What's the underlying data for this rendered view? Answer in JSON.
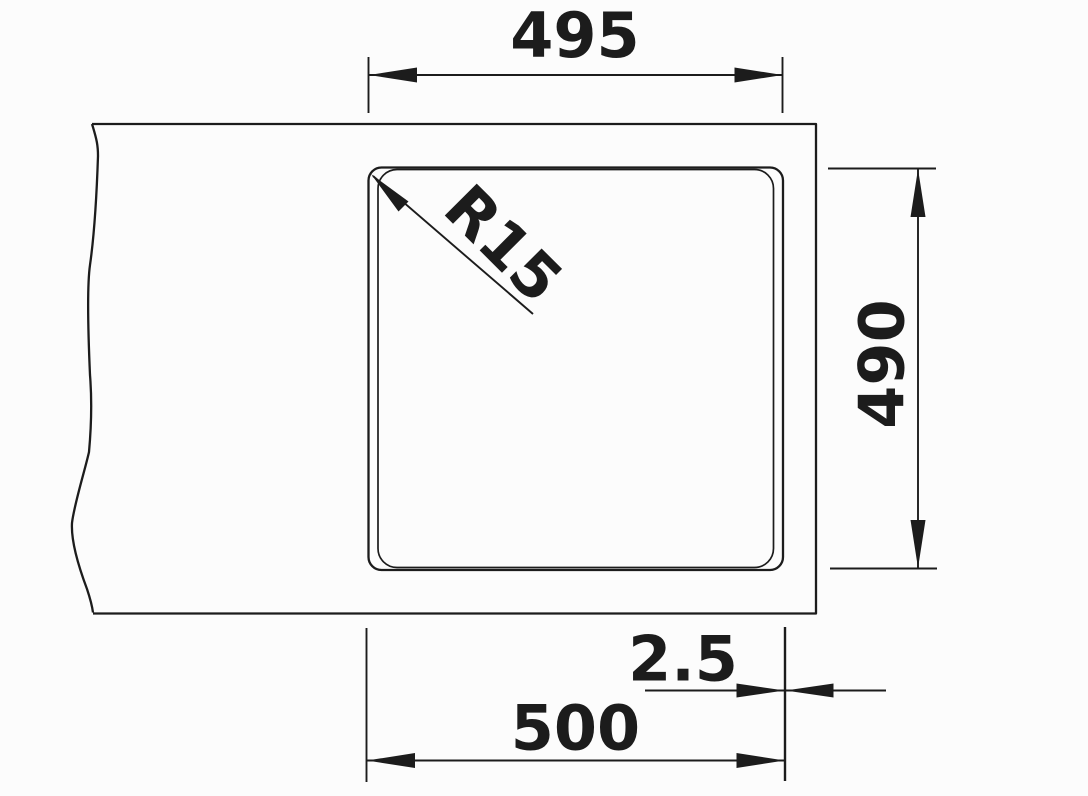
{
  "drawing": {
    "kind": "technical-dimension-drawing",
    "subject": "sink-cutout-plan-view",
    "line_color": "#1c1c1c",
    "background_color": "#fcfcfc",
    "dims": {
      "width_top": "495",
      "height_right": "490",
      "corner_radius": "R15",
      "edge_offset": "2.5",
      "width_bottom": "500"
    }
  }
}
